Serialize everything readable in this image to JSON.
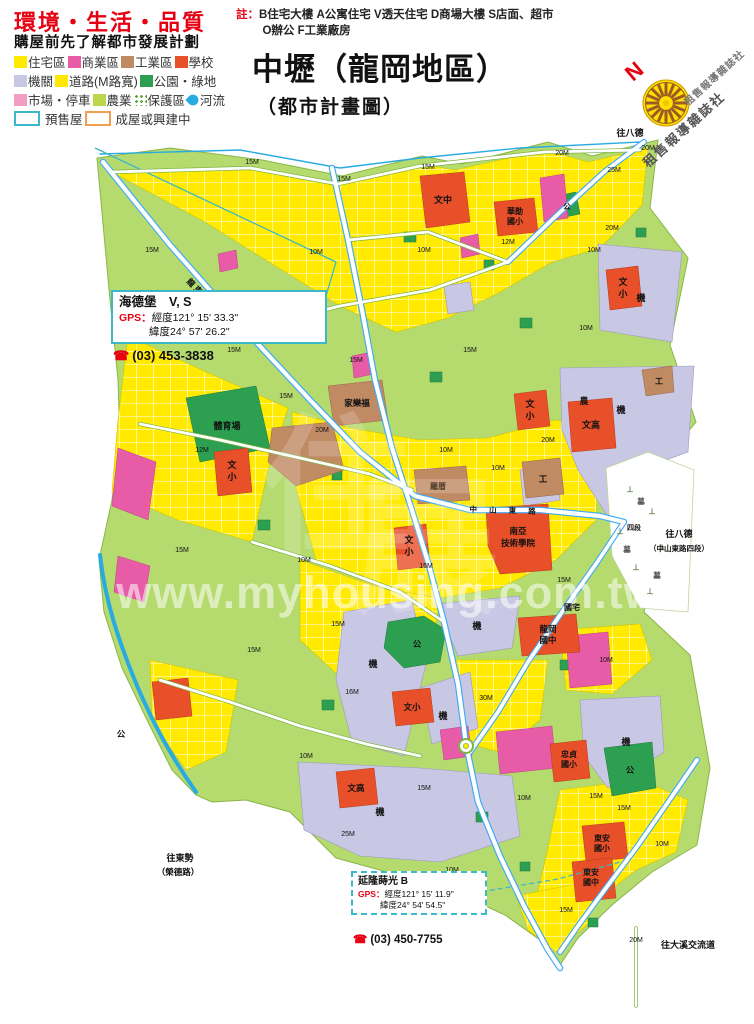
{
  "header": {
    "slogan": "環境・生活・品質",
    "slogan_sub": "購屋前先了解都市發展計劃",
    "note_label": "註：",
    "note_line1": "B住宅大樓 A公寓住宅 V透天住宅 D商場大樓 S店面、超市",
    "note_line2": "O辦公 F工業廠房",
    "title": "中壢（龍岡地區）",
    "subtitle": "（都市計畫圖）",
    "compass_n": "N",
    "compass_text": "租售報導雜誌社"
  },
  "legend": {
    "rows": [
      [
        {
          "label": "住宅區",
          "type": "swatch",
          "color": "#FFE900"
        },
        {
          "label": "商業區",
          "type": "swatch",
          "color": "#E75BA7"
        },
        {
          "label": "工業區",
          "type": "swatch",
          "color": "#C08A63"
        },
        {
          "label": "學校",
          "type": "swatch",
          "color": "#E8502A"
        }
      ],
      [
        {
          "label": "機關",
          "type": "swatch",
          "color": "#C8C7E4"
        },
        {
          "label": "道路(M路寬)",
          "type": "swatch",
          "color": "#FFE900"
        },
        {
          "label": "公園・綠地",
          "type": "swatch",
          "color": "#2CA050"
        }
      ],
      [
        {
          "label": "市場・停車",
          "type": "swatch",
          "color": "#F19EC2"
        },
        {
          "label": "農業",
          "type": "swatch",
          "color": "#BCD74B"
        },
        {
          "label": "保護區",
          "type": "dots"
        },
        {
          "label": "河流",
          "type": "river"
        }
      ],
      [
        {
          "label": "預售屋",
          "type": "box",
          "color": "#3BB8C9"
        },
        {
          "label": "成屋或興建中",
          "type": "box",
          "color": "#F0A050"
        }
      ]
    ]
  },
  "callouts": [
    {
      "name": "海德堡　V, S",
      "gps_label": "GPS：",
      "lng": "經度121° 15' 33.3\"",
      "lat": "緯度24° 57' 26.2\"",
      "phone": "(03) 453-3838"
    },
    {
      "name": "延隆蒔光 B",
      "gps_label": "GPS：",
      "lng": "經度121° 15' 11.9\"",
      "lat": "緯度24° 54' 54.5\"",
      "phone": "(03) 450-7755"
    }
  ],
  "map": {
    "palette": {
      "residential": "#FFEA00",
      "commercial": "#E75BA7",
      "industrial": "#C08A63",
      "school": "#E8502A",
      "government": "#C8C7E4",
      "park": "#2CA050",
      "market": "#F19EC2",
      "agriculture": "#B5DA6E",
      "river": "#29ABE2",
      "road_major_casing": "#3FA9F5",
      "road_minor_casing": "#7CB342",
      "presale_border": "#3BB8C9",
      "built_border": "#F0A050"
    },
    "watermark": "www.myhousing.com.tw",
    "labels": [
      {
        "t": "www.myhousing.com.tw",
        "x": 388,
        "y": 608,
        "s": 45,
        "c": "#ffffff",
        "o": 0.55,
        "w": 700,
        "ls": 1,
        "n": "watermark-text"
      },
      {
        "t": "住",
        "x": 335,
        "y": 540,
        "s": 150,
        "c": "#ffffff",
        "o": 0.18,
        "w": 700,
        "n": "watermark-logo"
      },
      {
        "t": "展",
        "x": 425,
        "y": 600,
        "s": 150,
        "c": "#ffffff",
        "o": 0.18,
        "w": 700,
        "n": "watermark-logo"
      },
      {
        "t": "文中",
        "x": 443,
        "y": 203,
        "s": 9
      },
      {
        "t": "華勛",
        "x": 515,
        "y": 214,
        "s": 8
      },
      {
        "t": "國小",
        "x": 515,
        "y": 224,
        "s": 8
      },
      {
        "t": "文",
        "x": 623,
        "y": 285,
        "s": 9
      },
      {
        "t": "小",
        "x": 623,
        "y": 297,
        "s": 9
      },
      {
        "t": "文",
        "x": 530,
        "y": 407,
        "s": 9
      },
      {
        "t": "小",
        "x": 530,
        "y": 419,
        "s": 9
      },
      {
        "t": "文高",
        "x": 591,
        "y": 428,
        "s": 9
      },
      {
        "t": "南亞",
        "x": 518,
        "y": 534,
        "s": 8.5
      },
      {
        "t": "技術學院",
        "x": 518,
        "y": 546,
        "s": 8.5
      },
      {
        "t": "文",
        "x": 409,
        "y": 543,
        "s": 9
      },
      {
        "t": "小",
        "x": 409,
        "y": 555,
        "s": 9
      },
      {
        "t": "文",
        "x": 232,
        "y": 468,
        "s": 9
      },
      {
        "t": "小",
        "x": 232,
        "y": 480,
        "s": 9
      },
      {
        "t": "龍岡",
        "x": 548,
        "y": 632,
        "s": 8.5
      },
      {
        "t": "國中",
        "x": 548,
        "y": 643,
        "s": 8.5
      },
      {
        "t": "國宅",
        "x": 572,
        "y": 610,
        "s": 8
      },
      {
        "t": "忠貞",
        "x": 569,
        "y": 757,
        "s": 8
      },
      {
        "t": "國小",
        "x": 569,
        "y": 767,
        "s": 8
      },
      {
        "t": "東安",
        "x": 602,
        "y": 841,
        "s": 8
      },
      {
        "t": "國小",
        "x": 602,
        "y": 851,
        "s": 8
      },
      {
        "t": "東安",
        "x": 591,
        "y": 875,
        "s": 8
      },
      {
        "t": "國中",
        "x": 591,
        "y": 885,
        "s": 8
      },
      {
        "t": "文小",
        "x": 412,
        "y": 710,
        "s": 8.5
      },
      {
        "t": "文高",
        "x": 356,
        "y": 791,
        "s": 8.5
      },
      {
        "t": "體育場",
        "x": 227,
        "y": 429,
        "s": 9
      },
      {
        "t": "家樂福",
        "x": 357,
        "y": 406,
        "s": 8.5
      },
      {
        "t": "羅厝",
        "x": 438,
        "y": 489,
        "s": 8,
        "c": "#4a3a28"
      },
      {
        "t": "機",
        "x": 641,
        "y": 301,
        "s": 9
      },
      {
        "t": "機",
        "x": 621,
        "y": 413,
        "s": 9
      },
      {
        "t": "機",
        "x": 373,
        "y": 667,
        "s": 9
      },
      {
        "t": "機",
        "x": 477,
        "y": 629,
        "s": 9
      },
      {
        "t": "機",
        "x": 443,
        "y": 719,
        "s": 9
      },
      {
        "t": "機",
        "x": 380,
        "y": 815,
        "s": 9
      },
      {
        "t": "機",
        "x": 626,
        "y": 745,
        "s": 9
      },
      {
        "t": "公",
        "x": 417,
        "y": 647,
        "s": 8.5
      },
      {
        "t": "公",
        "x": 630,
        "y": 773,
        "s": 8.5
      },
      {
        "t": "公",
        "x": 567,
        "y": 209,
        "s": 7.5
      },
      {
        "t": "公",
        "x": 121,
        "y": 737,
        "s": 8.5
      },
      {
        "t": "農",
        "x": 584,
        "y": 404,
        "s": 8.5
      },
      {
        "t": "工",
        "x": 543,
        "y": 482,
        "s": 8.5
      },
      {
        "t": "工",
        "x": 659,
        "y": 384,
        "s": 8
      },
      {
        "t": "墓",
        "x": 641,
        "y": 504,
        "s": 7.5,
        "c": "#444444"
      },
      {
        "t": "墓",
        "x": 627,
        "y": 552,
        "s": 7.5,
        "c": "#444444"
      },
      {
        "t": "墓",
        "x": 657,
        "y": 578,
        "s": 7.5,
        "c": "#444444"
      },
      {
        "t": "⊥",
        "x": 630,
        "y": 492,
        "s": 8,
        "c": "#567d46"
      },
      {
        "t": "⊥",
        "x": 652,
        "y": 514,
        "s": 8,
        "c": "#567d46"
      },
      {
        "t": "⊥",
        "x": 620,
        "y": 534,
        "s": 8,
        "c": "#567d46"
      },
      {
        "t": "⊥",
        "x": 662,
        "y": 550,
        "s": 8,
        "c": "#567d46"
      },
      {
        "t": "⊥",
        "x": 636,
        "y": 570,
        "s": 8,
        "c": "#567d46"
      },
      {
        "t": "⊥",
        "x": 650,
        "y": 594,
        "s": 8,
        "c": "#567d46"
      },
      {
        "t": "往八德",
        "x": 630,
        "y": 136,
        "s": 9,
        "n": "direction-label"
      },
      {
        "t": "20M",
        "x": 648,
        "y": 150,
        "s": 7,
        "w": 400
      },
      {
        "t": "往八德",
        "x": 679,
        "y": 537,
        "s": 9,
        "n": "direction-label"
      },
      {
        "t": "（中山東路四段）",
        "x": 679,
        "y": 551,
        "s": 7.5,
        "n": "direction-label"
      },
      {
        "t": "往東勢",
        "x": 180,
        "y": 861,
        "s": 9,
        "n": "direction-label"
      },
      {
        "t": "（榮德路）",
        "x": 178,
        "y": 875,
        "s": 8.5,
        "n": "direction-label"
      },
      {
        "t": "往大溪交流道",
        "x": 688,
        "y": 948,
        "s": 9,
        "n": "direction-label"
      },
      {
        "t": "龍 東 路",
        "x": 196,
        "y": 292,
        "s": 8,
        "r": 46,
        "n": "road-name"
      },
      {
        "t": "中 山 東 路",
        "x": 505,
        "y": 513,
        "s": 7.5,
        "r": 2,
        "ls": 5,
        "n": "road-name"
      },
      {
        "t": "四段",
        "x": 634,
        "y": 530,
        "s": 7,
        "n": "road-name"
      },
      {
        "t": "15M",
        "x": 252,
        "y": 164,
        "s": 7,
        "w": 400
      },
      {
        "t": "15M",
        "x": 344,
        "y": 181,
        "s": 7,
        "w": 400
      },
      {
        "t": "15M",
        "x": 428,
        "y": 169,
        "s": 7,
        "w": 400
      },
      {
        "t": "20M",
        "x": 562,
        "y": 155,
        "s": 7,
        "w": 400
      },
      {
        "t": "25M",
        "x": 614,
        "y": 172,
        "s": 7,
        "w": 400
      },
      {
        "t": "15M",
        "x": 152,
        "y": 252,
        "s": 7,
        "w": 400
      },
      {
        "t": "10M",
        "x": 316,
        "y": 254,
        "s": 7,
        "w": 400
      },
      {
        "t": "10M",
        "x": 424,
        "y": 252,
        "s": 7,
        "w": 400
      },
      {
        "t": "12M",
        "x": 508,
        "y": 244,
        "s": 7,
        "w": 400
      },
      {
        "t": "10M",
        "x": 594,
        "y": 252,
        "s": 7,
        "w": 400
      },
      {
        "t": "15M",
        "x": 234,
        "y": 352,
        "s": 7,
        "w": 400
      },
      {
        "t": "15M",
        "x": 356,
        "y": 362,
        "s": 7,
        "w": 400
      },
      {
        "t": "15M",
        "x": 470,
        "y": 352,
        "s": 7,
        "w": 400
      },
      {
        "t": "10M",
        "x": 586,
        "y": 330,
        "s": 7,
        "w": 400
      },
      {
        "t": "20M",
        "x": 612,
        "y": 230,
        "s": 7,
        "w": 400
      },
      {
        "t": "12M",
        "x": 202,
        "y": 452,
        "s": 7,
        "w": 400
      },
      {
        "t": "20M",
        "x": 322,
        "y": 432,
        "s": 7,
        "w": 400
      },
      {
        "t": "10M",
        "x": 446,
        "y": 452,
        "s": 7,
        "w": 400
      },
      {
        "t": "20M",
        "x": 548,
        "y": 442,
        "s": 7,
        "w": 400
      },
      {
        "t": "15M",
        "x": 286,
        "y": 398,
        "s": 7,
        "w": 400
      },
      {
        "t": "15M",
        "x": 182,
        "y": 552,
        "s": 7,
        "w": 400
      },
      {
        "t": "10M",
        "x": 304,
        "y": 562,
        "s": 7,
        "w": 400
      },
      {
        "t": "15M",
        "x": 426,
        "y": 568,
        "s": 7,
        "w": 400
      },
      {
        "t": "15M",
        "x": 564,
        "y": 582,
        "s": 7,
        "w": 400
      },
      {
        "t": "10M",
        "x": 498,
        "y": 470,
        "s": 7,
        "w": 400
      },
      {
        "t": "15M",
        "x": 254,
        "y": 652,
        "s": 7,
        "w": 400
      },
      {
        "t": "16M",
        "x": 352,
        "y": 694,
        "s": 7,
        "w": 400
      },
      {
        "t": "30M",
        "x": 486,
        "y": 700,
        "s": 7,
        "w": 400
      },
      {
        "t": "10M",
        "x": 606,
        "y": 662,
        "s": 7,
        "w": 400
      },
      {
        "t": "15M",
        "x": 338,
        "y": 626,
        "s": 7,
        "w": 400
      },
      {
        "t": "10M",
        "x": 306,
        "y": 758,
        "s": 7,
        "w": 400
      },
      {
        "t": "15M",
        "x": 424,
        "y": 790,
        "s": 7,
        "w": 400
      },
      {
        "t": "10M",
        "x": 524,
        "y": 800,
        "s": 7,
        "w": 400
      },
      {
        "t": "15M",
        "x": 624,
        "y": 810,
        "s": 7,
        "w": 400
      },
      {
        "t": "25M",
        "x": 348,
        "y": 836,
        "s": 7,
        "w": 400
      },
      {
        "t": "10M",
        "x": 452,
        "y": 872,
        "s": 7,
        "w": 400
      },
      {
        "t": "15M",
        "x": 566,
        "y": 912,
        "s": 7,
        "w": 400
      },
      {
        "t": "20M",
        "x": 636,
        "y": 942,
        "s": 7,
        "w": 400
      },
      {
        "t": "15M",
        "x": 596,
        "y": 798,
        "s": 7,
        "w": 400
      },
      {
        "t": "10M",
        "x": 662,
        "y": 846,
        "s": 7,
        "w": 400
      }
    ]
  }
}
